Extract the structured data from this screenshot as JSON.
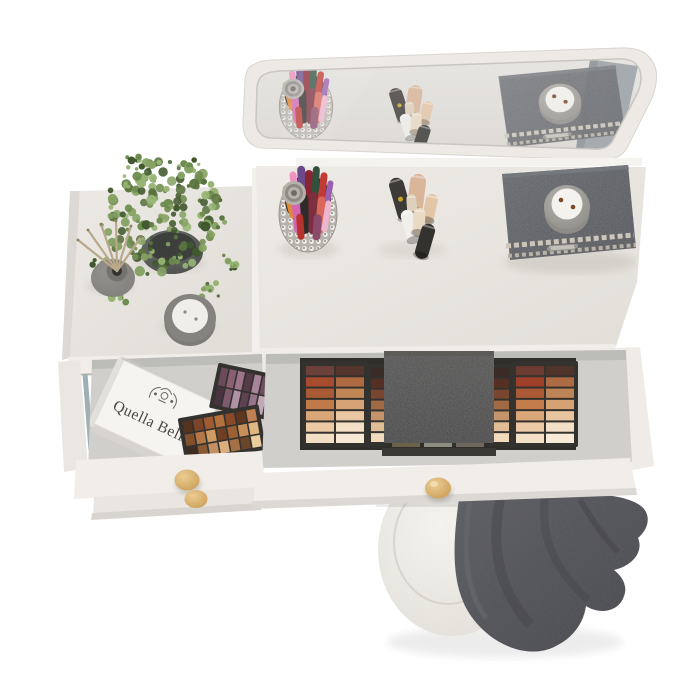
{
  "scene": {
    "background": "#ffffff"
  },
  "colors": {
    "surface": "#e8e5e0",
    "surface_light": "#f1eee9",
    "frame": "#edeae5",
    "glass": "#e3e0dc",
    "mirror_side": "#9aa0a5",
    "drawer_interior": "#d0cfcc",
    "drawer_front": "#f1eee9",
    "drawer_front2": "#e9e6e1",
    "knob": "#dfb477",
    "box_dark": "#595c60",
    "box_trim": "#ccc6ba",
    "candle_holder": "#a09e99",
    "wax": "#f4f2ee",
    "wick": "#7a4a28",
    "pot": "#5f625f",
    "diffuser": "#75736e",
    "stick": "#b9a88a",
    "jar_ring": "#85837f",
    "jar_wax": "#eceae5",
    "pouf": "#eae8e2",
    "blanket": "#55565a",
    "palette_frame": "#34322f",
    "lid": "#4b4a47",
    "cup": "#b7b3ac",
    "glide": "#9fb0b4",
    "brand_text": "#4a4846",
    "foliage": [
      "#42592f",
      "#5a7440",
      "#6f8c50",
      "#85a263",
      "#97b474"
    ]
  },
  "giftbox": {
    "brand": "Quella Bella"
  },
  "brush_holder": {
    "brushes": [
      "#e08a33",
      "#f093c0",
      "#6a4a8a",
      "#8a2430",
      "#32503e",
      "#c23a33",
      "#9a5fb0",
      "#d465ae",
      "#2e2b29",
      "#7c2f3e",
      "#d8685a",
      "#edb6ce",
      "#b8322e",
      "#8a4a6a"
    ]
  },
  "tubes": {
    "colors": [
      "#3d3b37",
      "#d9b59a",
      "#f1efe9",
      "#e9dac3",
      "#34322f",
      "#e3c5a7",
      "#ded0ba"
    ]
  },
  "palettes": {
    "plum": {
      "rows": [
        [
          "#6b4a59",
          "#8a5f74",
          "#9d7489",
          "#553a48",
          "#a8849a",
          "#6e4e5e",
          "#8f6a7f"
        ],
        [
          "#4a3340",
          "#7d5a6c",
          "#b092a5",
          "#5f4251",
          "#96758a",
          "#c2a7b7",
          "#6a4a5a"
        ]
      ]
    },
    "warm": {
      "rows": [
        [
          "#55331f",
          "#7d4527",
          "#a05c30",
          "#b4713d",
          "#8a4a27",
          "#5f3620",
          "#c08050"
        ],
        [
          "#84502c",
          "#b47747",
          "#d09a63",
          "#6e3f23",
          "#9c6035",
          "#c89059",
          "#e0b681"
        ],
        [
          "#3f2c20",
          "#8a5a33",
          "#c49063",
          "#dcae7d",
          "#a47147",
          "#6a452b",
          "#eccd9e"
        ]
      ]
    },
    "train_case": {
      "left_cols": [
        [
          "#6b4038",
          "#a84b2e",
          "#a85a33",
          "#c07a4a",
          "#d9a677",
          "#ebc9a4",
          "#f2dfc4"
        ],
        [
          "#53352b",
          "#b06a41",
          "#c08656",
          "#d6a376",
          "#e8c7a2",
          "#f3e0c6",
          "#f6ead6"
        ]
      ],
      "left_strip": [
        "#3a2b26",
        "#552f23",
        "#7a4630",
        "#a06a44",
        "#c4956a",
        "#e0bd95",
        "#f0dabb"
      ],
      "right_cols": [
        [
          "#6b3a30",
          "#a04029",
          "#ab5a35",
          "#c47c4c",
          "#daa878",
          "#eccaa6",
          "#f3e0c6"
        ],
        [
          "#513429",
          "#ae6a42",
          "#bd8455",
          "#d5a274",
          "#e7c5a0",
          "#f2dfc5",
          "#f7ebd8"
        ]
      ],
      "right_strip": [
        "#3a2b26",
        "#552f23",
        "#7a4630",
        "#a06a44",
        "#c4956a",
        "#e0bd95",
        "#f0dabb"
      ],
      "tray": [
        "#6b6148",
        "#8d8d80",
        "#6e685c"
      ]
    }
  }
}
